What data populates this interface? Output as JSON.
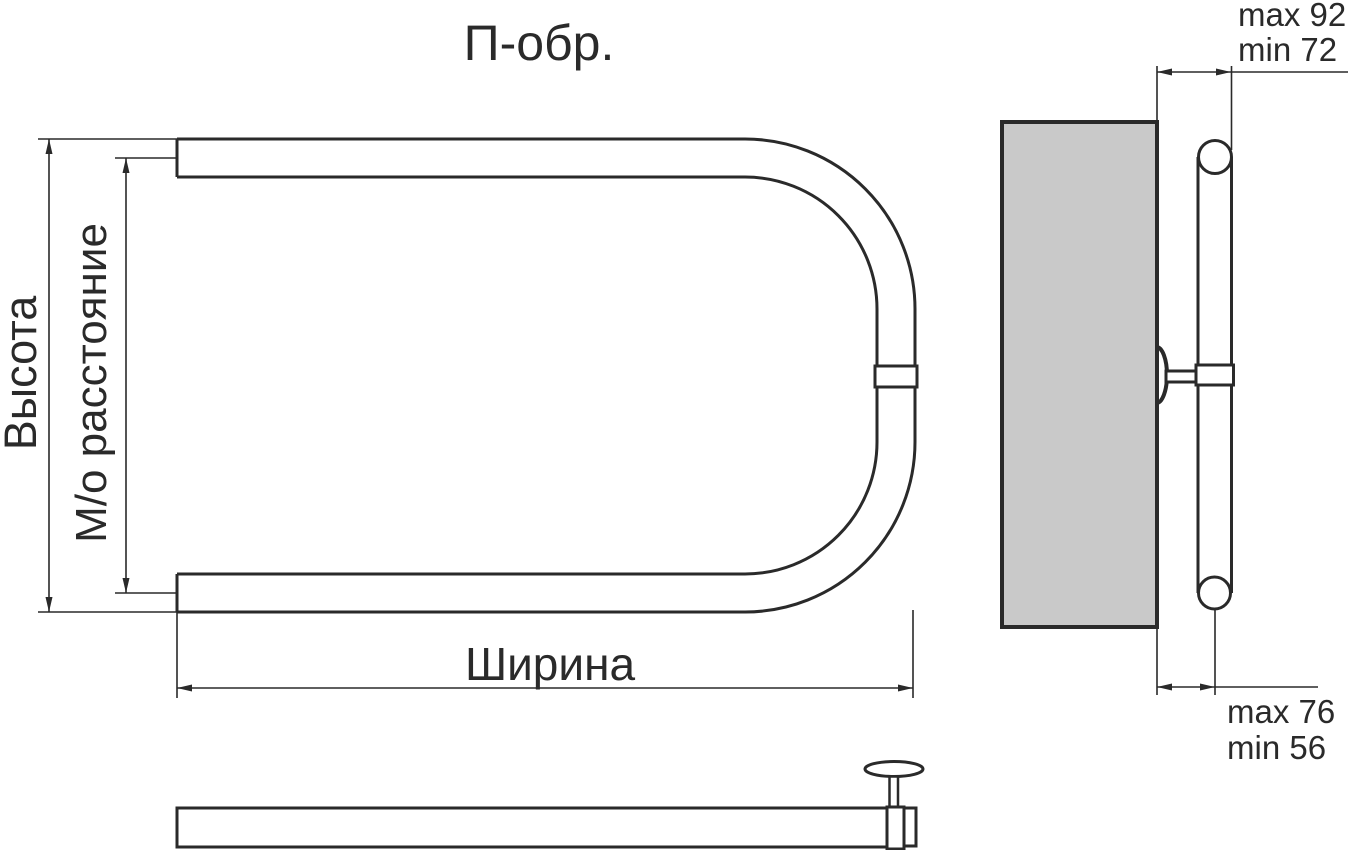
{
  "title": "П-обр.",
  "front_view": {
    "height_label": "Высота",
    "center_distance_label": "М/о расстояние",
    "width_label": "Ширина"
  },
  "side_view": {
    "depth_to_outer": {
      "max": "max 92",
      "min": "min 72"
    },
    "depth_to_axis": {
      "max": "max 76",
      "min": "min 56"
    }
  },
  "colors": {
    "line": "#2a2a2a",
    "wall_fill": "#c9c9c9",
    "background": "#ffffff"
  }
}
